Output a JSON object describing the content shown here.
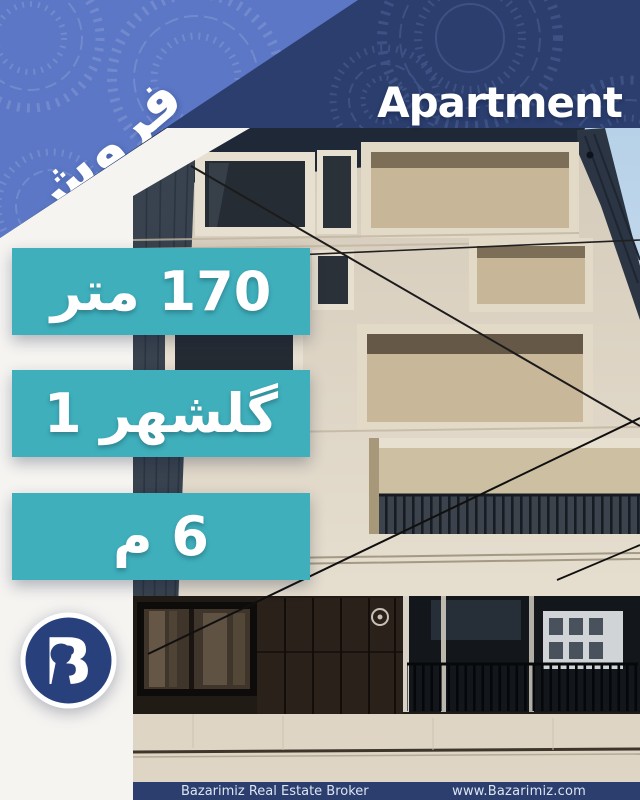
{
  "poster": {
    "ribbon": {
      "label": "فروش"
    },
    "title": "Apartment",
    "badges": [
      {
        "label": "170 متر"
      },
      {
        "label": "گلشهر 1"
      },
      {
        "label": "6 م"
      }
    ],
    "logo": {
      "letter": "B"
    },
    "footer": {
      "broker_name": "Bazarimiz Real Estate Broker",
      "website": "www.Bazarimiz.com"
    },
    "colors": {
      "navy": "#2b3e6e",
      "periwinkle": "#5b77c5",
      "teal": "#3fafbc",
      "offwhite": "#f5f4f1",
      "logo_navy": "#28407b",
      "footer_text": "#dce4f2"
    }
  }
}
